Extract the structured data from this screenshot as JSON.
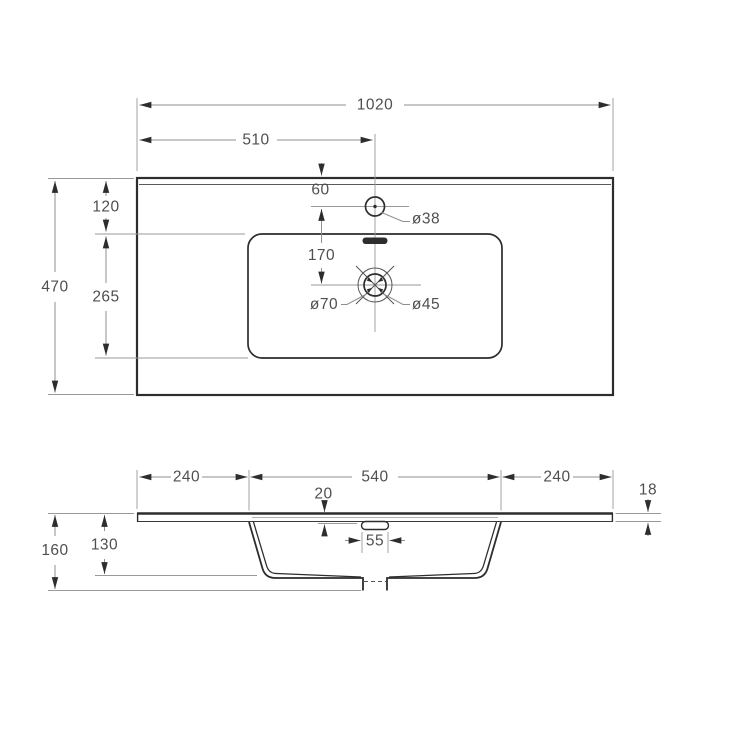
{
  "drawing": {
    "type": "technical-dimension-drawing",
    "subject": "vanity washbasin top, plan view and front section",
    "units": "mm"
  },
  "colors": {
    "background": "#ffffff",
    "outline": "#2d2d2d",
    "dimension_lines": "#8f8f8f",
    "text": "#4f4f4f"
  },
  "top_view": {
    "labels": {
      "overall_width": "1020",
      "center_width": "510",
      "faucet_offset": "60",
      "back_to_basin": "120",
      "overall_depth": "470",
      "basin_depth": "265",
      "faucet_to_drain": "170",
      "faucet_hole_dia": "ø38",
      "drain_outer_dia": "ø70",
      "drain_hole_dia": "ø45"
    }
  },
  "section_view": {
    "labels": {
      "left_deck": "240",
      "basin_width": "540",
      "right_deck": "240",
      "overflow_drop": "20",
      "slab_thickness": "18",
      "overflow_width": "55",
      "overall_height": "160",
      "bowl_depth": "130"
    }
  }
}
